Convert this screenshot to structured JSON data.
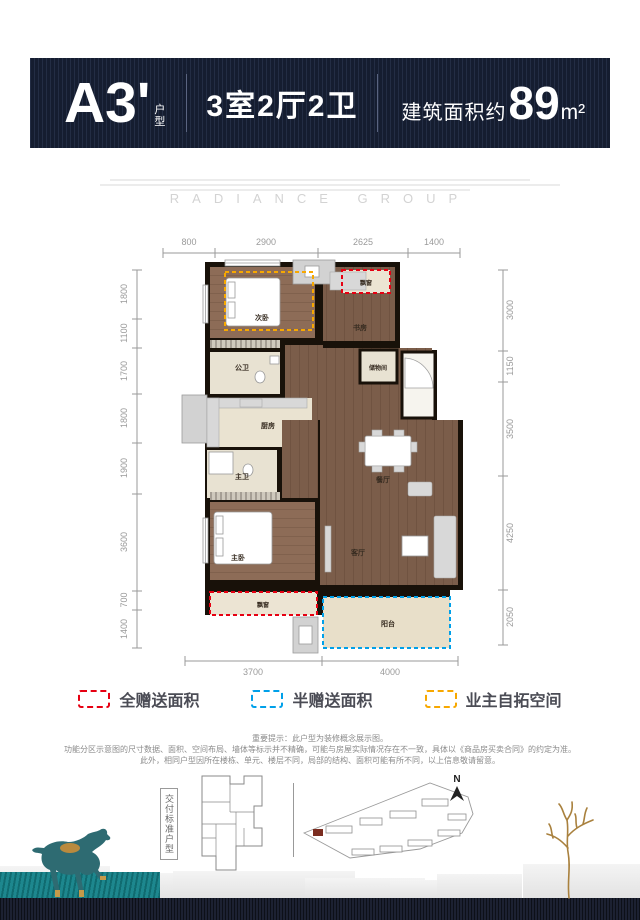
{
  "header": {
    "unit_code": "A3'",
    "unit_type_label": "户型",
    "rooms_summary": "3室2厅2卫",
    "area_prefix": "建筑面积约",
    "area_value": "89",
    "area_unit": "m²"
  },
  "watermark": "RADIANCE GROUP",
  "plan": {
    "dims_top": [
      "800",
      "2900",
      "2625",
      "1400"
    ],
    "dims_bottom": [
      "3700",
      "4000"
    ],
    "dims_left": [
      "1800",
      "1100",
      "1700",
      "1800",
      "1900",
      "3600",
      "700",
      "1400"
    ],
    "dims_right": [
      "3000",
      "1150",
      "3500",
      "4250",
      "2050"
    ],
    "rooms": {
      "second_bedroom": "次卧",
      "study": "书房",
      "bay_window_top": "飘窗",
      "guest_bathroom": "公卫",
      "storage": "储物间",
      "kitchen": "厨房",
      "master_bathroom": "主卫",
      "dining_room": "餐厅",
      "master_bedroom": "主卧",
      "living_room": "客厅",
      "bay_window_bottom": "飘窗",
      "balcony": "阳台"
    }
  },
  "legend": [
    {
      "label": "全赠送面积",
      "color": "#e60012"
    },
    {
      "label": "半赠送面积",
      "color": "#00a0e9"
    },
    {
      "label": "业主自拓空间",
      "color": "#f7a800"
    }
  ],
  "disclaimer": [
    "重要提示：此户型为装修概念展示图。",
    "功能分区示意图的尺寸数据、面积、空间布局、墙体等标示并不精确，可能与房屋实际情况存在不一致，具体以《商品房买卖合同》的约定为准。",
    "此外，相同户型因所在楼栋、单元、楼层不同，局部的结构、面积可能有所不同，以上信息敬请留意。"
  ],
  "footer": {
    "delivery_label": "交付标准户型",
    "compass_n": "N"
  },
  "colors": {
    "header_bg": "#1a2234",
    "accent_teal": "#148289",
    "full_gift_red": "#e60012",
    "half_gift_blue": "#00a0e9",
    "owner_expand_yellow": "#f7a800"
  }
}
